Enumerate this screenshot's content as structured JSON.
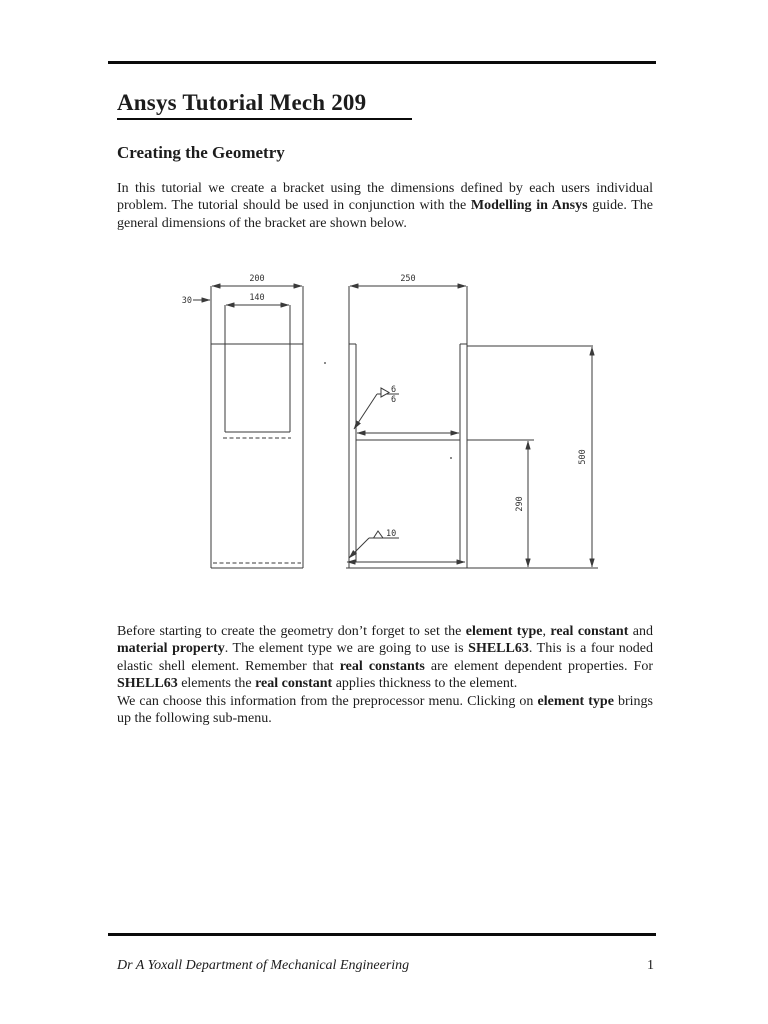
{
  "document": {
    "title": "Ansys Tutorial Mech 209",
    "section_heading": "Creating the Geometry",
    "paragraphs": {
      "intro": [
        {
          "text": "In this tutorial we create a bracket using the dimensions defined by each users individual problem. The tutorial should be used in conjunction with the ",
          "bold": false
        },
        {
          "text": "Modelling in Ansys",
          "bold": true
        },
        {
          "text": " guide. The general dimensions of the bracket are shown below.",
          "bold": false
        }
      ],
      "element_type": [
        {
          "text": "Before starting to create the geometry don’t forget to set the ",
          "bold": false
        },
        {
          "text": "element type",
          "bold": true
        },
        {
          "text": ", ",
          "bold": false
        },
        {
          "text": "real constant",
          "bold": true
        },
        {
          "text": " and ",
          "bold": false
        },
        {
          "text": "material property",
          "bold": true
        },
        {
          "text": ". The element type we are going to use is ",
          "bold": false
        },
        {
          "text": "SHELL63",
          "bold": true
        },
        {
          "text": ". This is a four noded elastic shell element. Remember that ",
          "bold": false
        },
        {
          "text": "real constants",
          "bold": true
        },
        {
          "text": " are element dependent properties. For ",
          "bold": false
        },
        {
          "text": "SHELL63",
          "bold": true
        },
        {
          "text": " elements the ",
          "bold": false
        },
        {
          "text": "real constant",
          "bold": true
        },
        {
          "text": " applies thickness to the element.",
          "bold": false
        }
      ],
      "preprocessor": [
        {
          "text": "We can choose this information from the preprocessor menu. Clicking on ",
          "bold": false
        },
        {
          "text": "element type",
          "bold": true
        },
        {
          "text": " brings up the following sub-menu.",
          "bold": false
        }
      ]
    },
    "drawing": {
      "dimension_labels": {
        "front_width": "200",
        "edge_offset": "30",
        "inner_plate_width": "140",
        "side_depth": "250",
        "overall_height": "500",
        "shelf_height": "290",
        "top_weld_upper": "6",
        "top_weld_lower": "6",
        "bottom_weld": "10"
      }
    },
    "footer": {
      "author": "Dr A Yoxall Department of Mechanical Engineering",
      "page_number": "1"
    }
  }
}
